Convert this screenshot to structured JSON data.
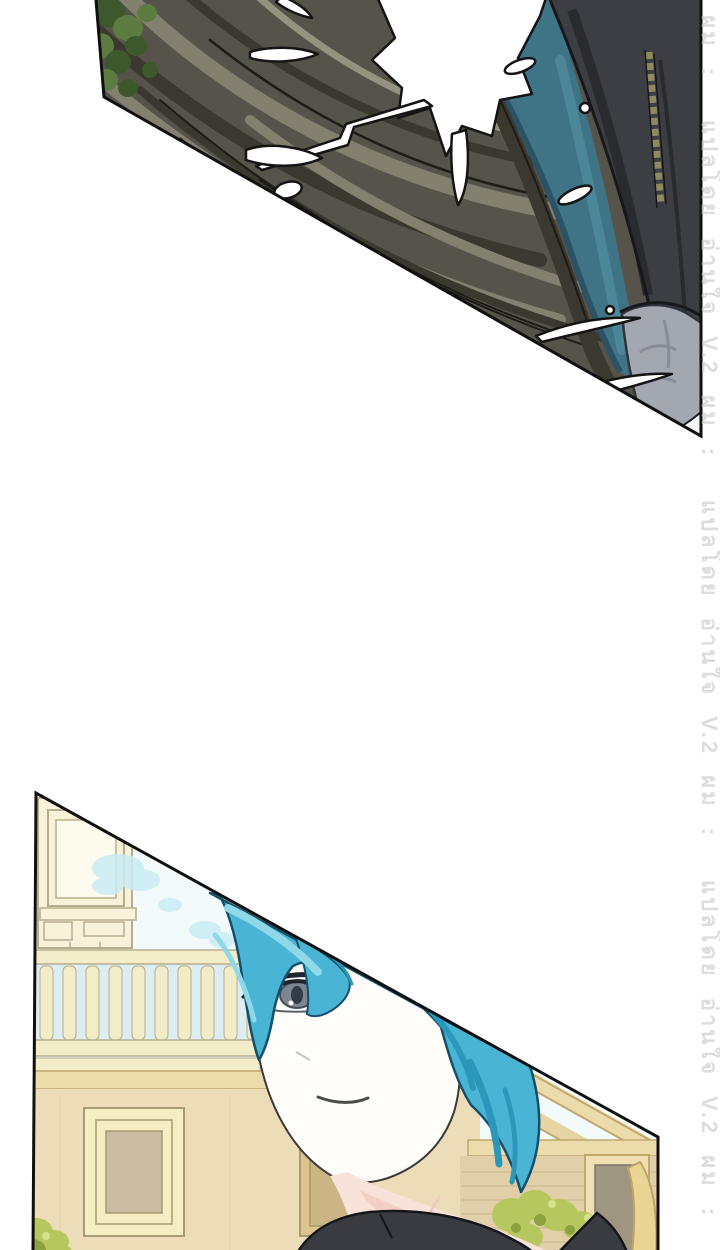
{
  "watermark": {
    "text": "แปลโดย อ่านใจ V.2 ผม :",
    "repeat": 4,
    "color": "#c6c6c6"
  },
  "panels": [
    {
      "id": "top-panel"
    },
    {
      "id": "bottom-panel"
    }
  ],
  "colors": {
    "paper": "#ffffff",
    "border": "#101010",
    "watermark": "#c6c6c6",
    "p1_hair": "#56534a",
    "p1_hair_light": "#83806f",
    "p1_hair_lighter": "#95927f",
    "p1_hair_dark": "#3a382f",
    "p1_hair_deep": "#26251f",
    "p1_outline": "#1d1c17",
    "leaf_light": "#5d7c41",
    "leaf_dark": "#3c582c",
    "teal": "#3e7486",
    "teal_dark": "#2b5365",
    "teal_light": "#4d8699",
    "jacket": "#3d3e43",
    "jacket_dark": "#2a2b2f",
    "ink": "#17181b",
    "zipper": "#8d8a5e",
    "hand": "#a2a7b0",
    "hand_shadow": "#878d98",
    "splash": "#ffffff",
    "sky": "#f2fafc",
    "cloud": "#c9ecf4",
    "cloud2": "#dceef2",
    "cream": "#f8f2da",
    "cream2": "#f3ecc8",
    "cream_line": "#b7ae8e",
    "molding": "#eddcab",
    "molding_dark": "#c2a76f",
    "wall_left": "#ecddb8",
    "window_frame": "#f6eec3",
    "window_line": "#a89a74",
    "window_pane": "#c9bca0",
    "window_pane2": "#cbb584",
    "window_frame2": "#dcc48c",
    "wall_right": "#e0cfa8",
    "brick": "#cdb78d",
    "door": "#9e9680",
    "door_frame": "#eee0b2",
    "tan_object": "#ead493",
    "tan_line": "#bfa469",
    "bush": "#b6c75f",
    "bush_dark": "#8ba23f",
    "bush_light": "#d6e18c",
    "char_hair": "#4ab4d4",
    "char_hair_light": "#8fd8e8",
    "char_hair_dark": "#2b97ba",
    "char_hair_line": "#14506a",
    "skin": "#fffdfa",
    "neck": "#f8e2da",
    "neck_deep": "#efc9c0",
    "iris": "#7d8792",
    "pupil": "#333b45",
    "lash": "#20242b",
    "brow": "#5b6166",
    "mouth": "#4e4a48",
    "suit": "#3a3b40"
  }
}
